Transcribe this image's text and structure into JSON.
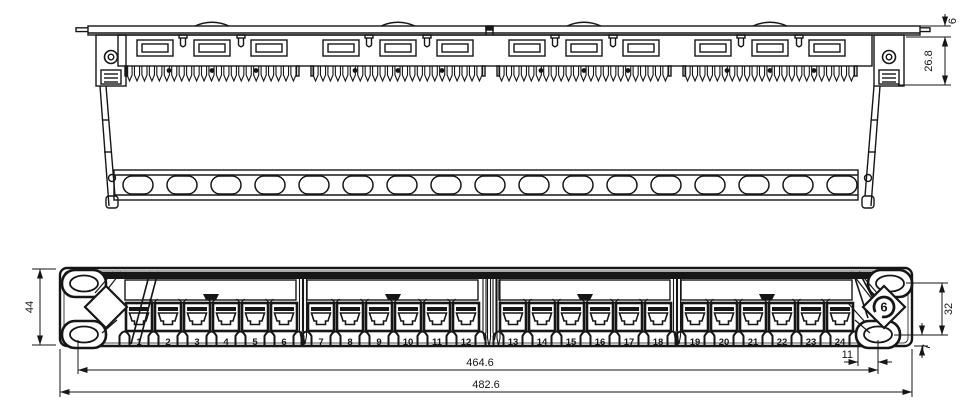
{
  "colors": {
    "line": "#161616",
    "background": "#ffffff"
  },
  "dims": {
    "front": {
      "panel_height": "44",
      "hole_span": "32",
      "hole_inset": "11",
      "hole_bottom": "7",
      "mount_span": "464.6",
      "panel_width": "482.6"
    },
    "top": {
      "lip": "6",
      "depth": "26.8"
    }
  },
  "front_view": {
    "ports": {
      "groups": 4,
      "per_group": 6,
      "numbers": [
        "1",
        "2",
        "3",
        "4",
        "5",
        "6",
        "7",
        "8",
        "9",
        "10",
        "11",
        "12",
        "13",
        "14",
        "15",
        "16",
        "17",
        "18",
        "19",
        "20",
        "21",
        "22",
        "23",
        "24"
      ]
    },
    "logo": {
      "text": "6"
    }
  },
  "top_view": {
    "counts": {
      "slots_per_group": 3,
      "clips_per_group": 2,
      "tooth_segments": 4,
      "teeth_per_segment": 23,
      "cable_slots": 17,
      "bumps": 4
    }
  }
}
